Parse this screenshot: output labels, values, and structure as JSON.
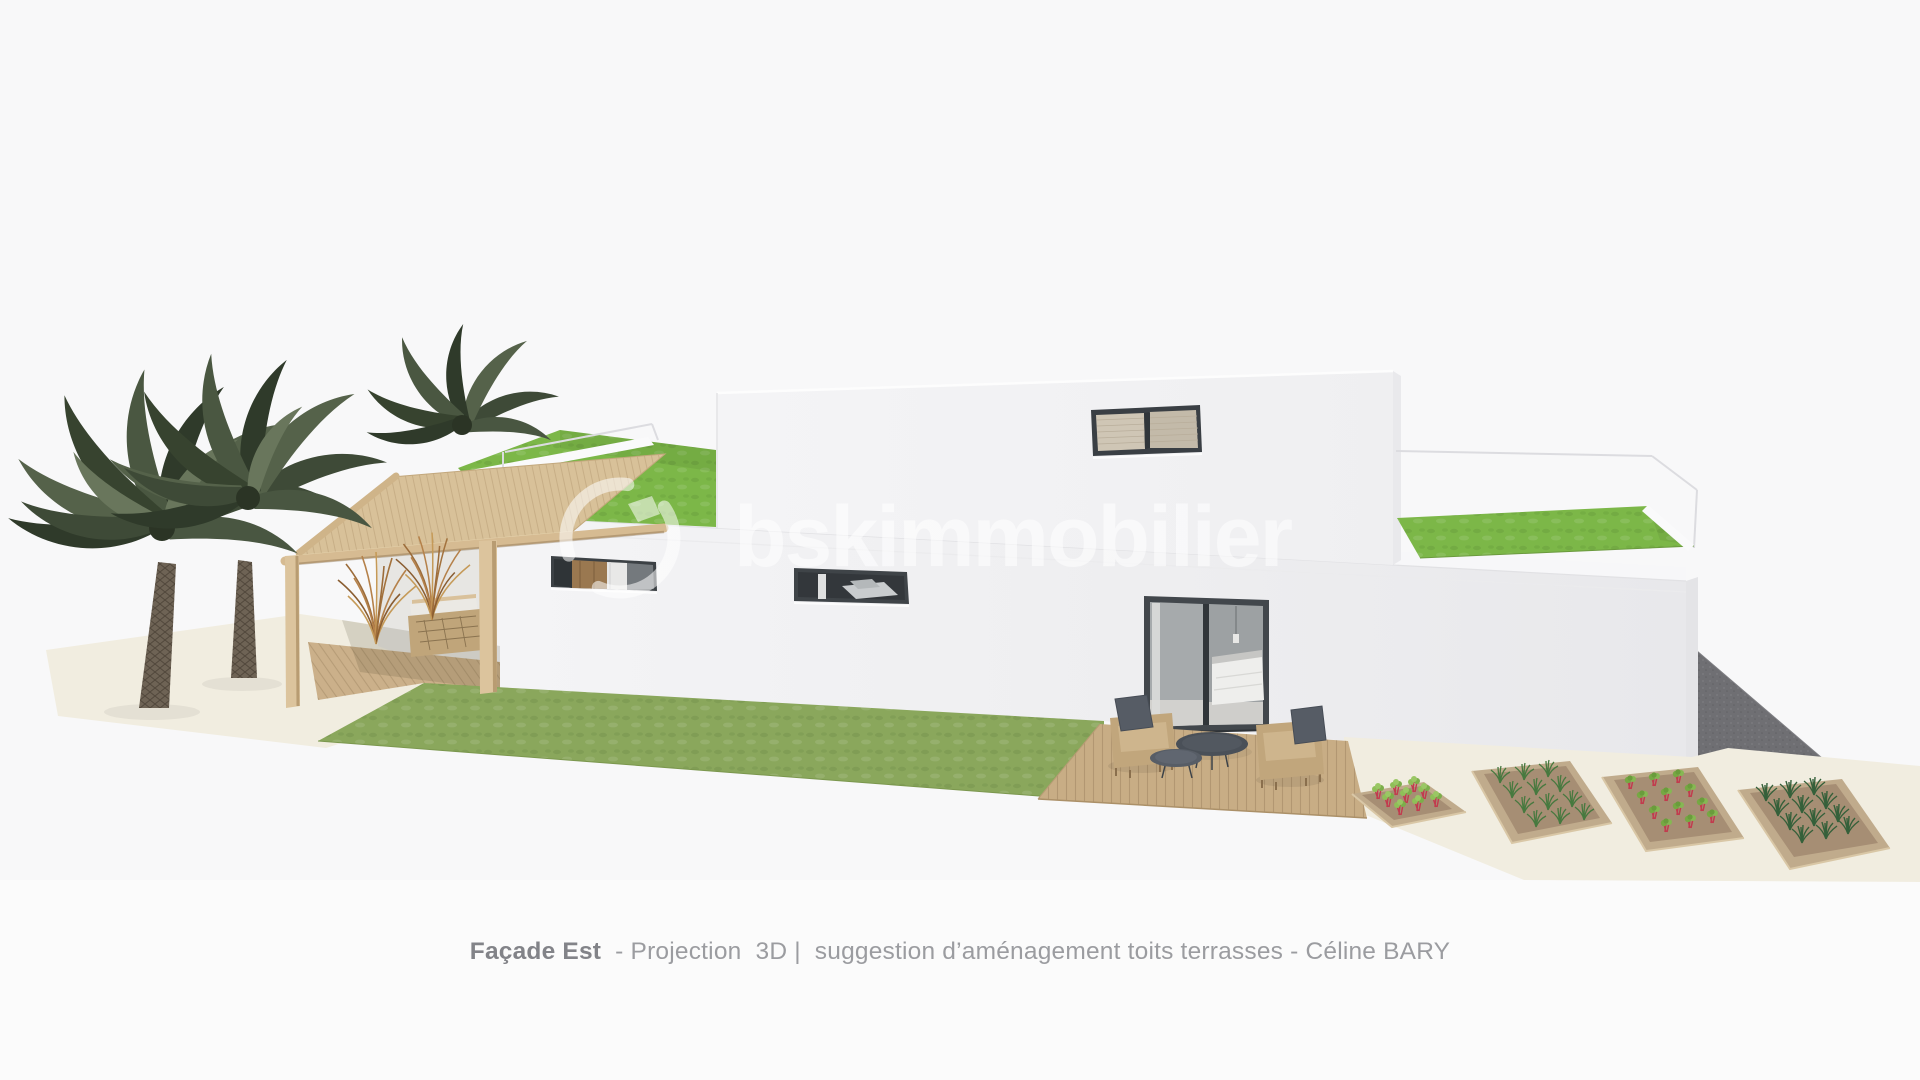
{
  "caption": {
    "title": "Façade Est",
    "rest": "  - Projection  3D |  suggestion d’aménagement toits terrasses - Céline BARY"
  },
  "watermark": {
    "text": "bskimmobilier",
    "logo": "bsk-logo",
    "color": "rgba(255,255,255,0.55)"
  },
  "palette": {
    "background": "#f8f8f9",
    "wall_white": "#f0f0f2",
    "front_lawn_green": "#8aa75c",
    "roof_lawn_green": "#7cb748",
    "deck_wood": "#c8ad85",
    "pergola_wood": "#d8c199",
    "driveway_gray": "#6f6f73",
    "window_frame_dark": "#3e4347",
    "ground_cream": "#f1ede0",
    "caption_gray": "#9b9ca0"
  },
  "scene": {
    "objects": [
      "palm-trees",
      "pergola",
      "dried-grasses",
      "modern-white-house",
      "roof-terrace-lawns",
      "glass-railings",
      "strip-windows",
      "sliding-glass-door",
      "wood-deck",
      "wicker-armchairs",
      "coffee-tables",
      "front-lawn",
      "raised-garden-beds",
      "driveway"
    ]
  }
}
